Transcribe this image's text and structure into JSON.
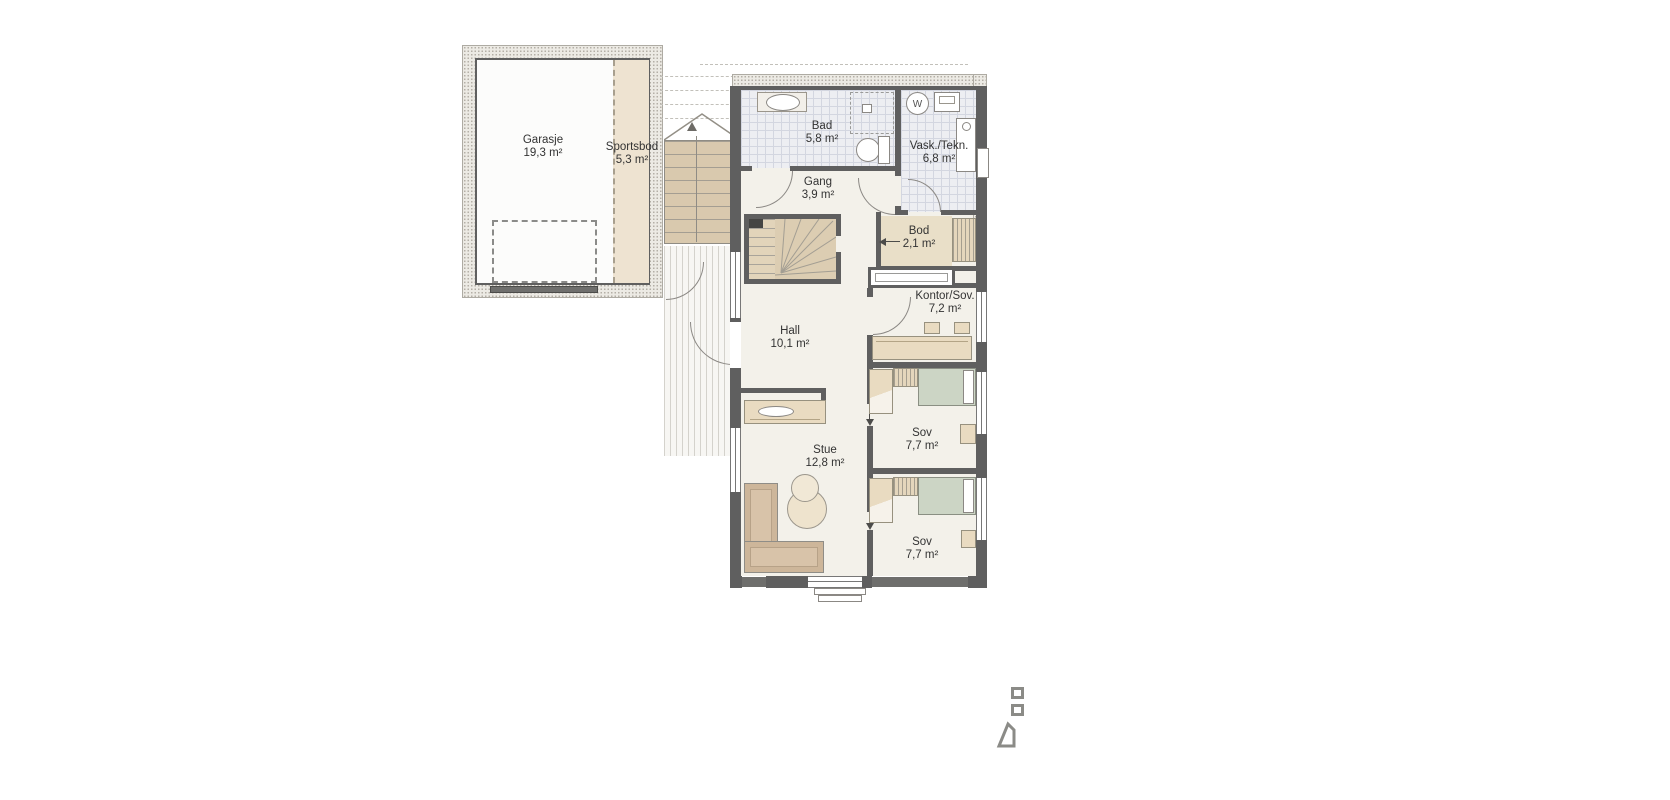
{
  "plan": {
    "rooms": {
      "garasje": {
        "name": "Garasje",
        "area": "19,3 m²"
      },
      "sportsbod": {
        "name": "Sportsbod",
        "area": "5,3 m²"
      },
      "bad": {
        "name": "Bad",
        "area": "5,8 m²"
      },
      "vask_tekn": {
        "name": "Vask./Tekn.",
        "area": "6,8 m²"
      },
      "gang": {
        "name": "Gang",
        "area": "3,9 m²"
      },
      "bod": {
        "name": "Bod",
        "area": "2,1 m²"
      },
      "kontor_sov": {
        "name": "Kontor/Sov.",
        "area": "7,2 m²"
      },
      "hall": {
        "name": "Hall",
        "area": "10,1 m²"
      },
      "stue": {
        "name": "Stue",
        "area": "12,8 m²"
      },
      "sov_1": {
        "name": "Sov",
        "area": "7,7 m²"
      },
      "sov_2": {
        "name": "Sov",
        "area": "7,7 m²"
      }
    },
    "appliances": {
      "washer_label": "W"
    },
    "colors": {
      "wall": "#5f5f5f",
      "floor": "#f3f1ea",
      "tile": "#edeef2",
      "wood_stairs": "#d9c9ae",
      "furniture_tan": "#e9dbc1",
      "sofa": "#cdb69a",
      "bed_green": "#ccd5c5",
      "stipple_wall": "#eceae4"
    }
  }
}
